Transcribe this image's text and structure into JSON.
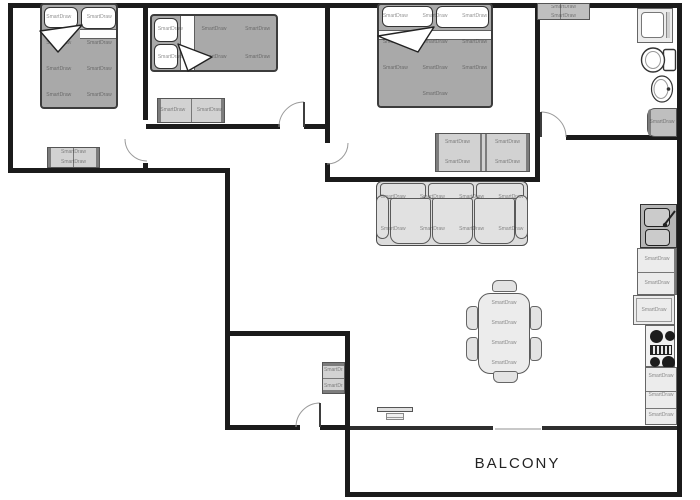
{
  "labels": {
    "balcony": "BALCONY"
  },
  "watermark": "SmartDraw",
  "colors": {
    "wall": "#1b1b1b",
    "blanket": "#a9a9a9",
    "furn_mid": "#d2d2d2",
    "sink_dark": "#b5b5b5"
  }
}
